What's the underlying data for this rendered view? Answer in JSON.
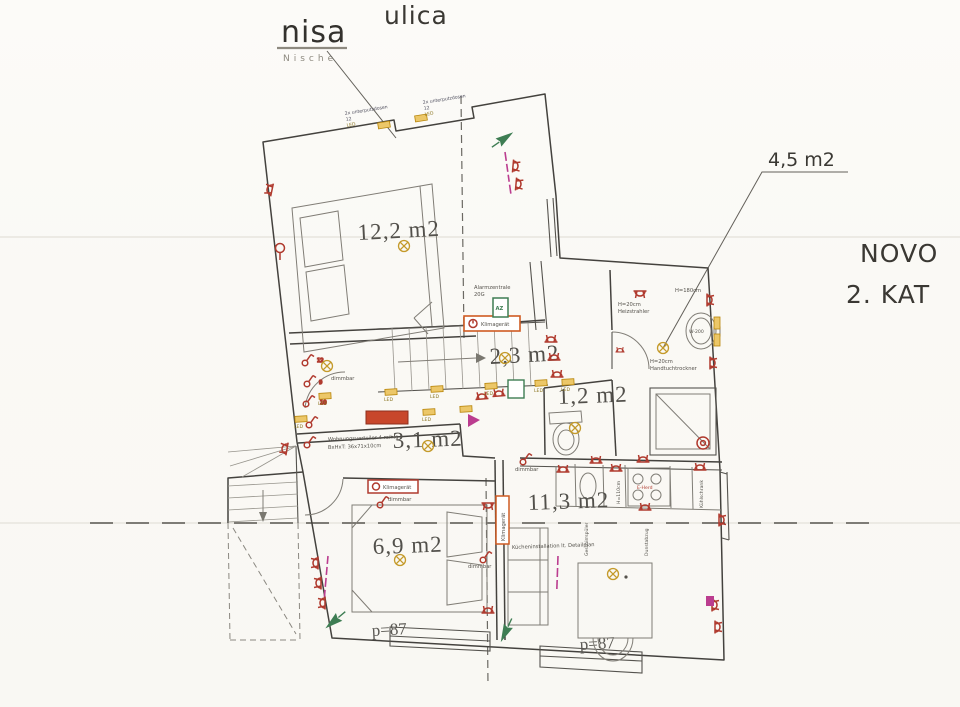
{
  "titles": {
    "nisa": "nisa",
    "nische": "Nische",
    "ulica": "ulica",
    "novo": "NOVO",
    "kat": "2. KAT",
    "bath_area": "4,5 m2"
  },
  "rooms": {
    "bedroom1": "12,2 m2",
    "hall": "2,3 m2",
    "wc": "1,2 m2",
    "corridor": "3,1 m2",
    "living": "11,3 m2",
    "bedroom2": "6,9 m2"
  },
  "parapet": "p=87",
  "notes": {
    "flush_boxes": "2x unterputzdosen",
    "flush_qty": "12",
    "led": "LED",
    "alarm1": "Alarmzentrale",
    "alarm2": "20G",
    "az": "AZ",
    "klima": "Klimagerät",
    "dimmbar": "dimmbar",
    "verteiler1": "Wohnungsverteiler 4-reihig",
    "verteiler2": "BxHxT: 36x71x10cm",
    "kitchen": "Kücheninstallation lt. Detailplan",
    "heater_h": "H=20cm",
    "heater": "Heizstrahler",
    "h180": "H=180cm",
    "towel_h": "H=20cm",
    "towel": "Handtuchtrockner",
    "sink": "W-200",
    "stove": "E-Herd",
    "dishwasher": "Geschirrspüler",
    "h110": "H=110cm",
    "hood": "Dunstabzug",
    "fridge": "Kühlschrank",
    "sw12": "12",
    "sw9": "9",
    "sw10": "10"
  },
  "colors": {
    "wall": "#44423e",
    "electric_red": "#b03a2e",
    "led_yellow": "#d9a62e",
    "klima_orange": "#cf5b22",
    "alarm_green": "#3e7d53",
    "note_magenta": "#bb3d8f"
  }
}
